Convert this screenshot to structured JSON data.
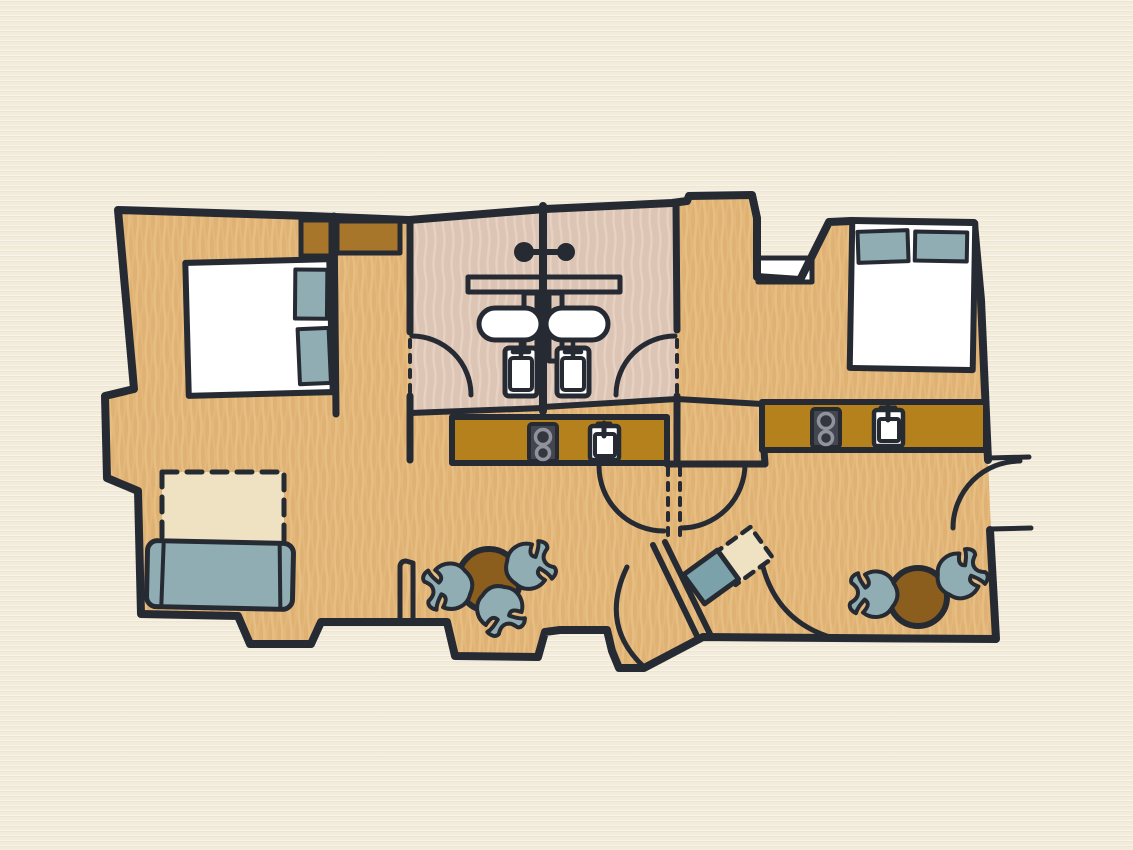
{
  "scene": {
    "type": "hand-drawn floor plan",
    "description": "Top-down illustrated floor plan of two mirrored studio apartments sharing a central bathroom block and entry vestibule",
    "units": 2,
    "visible_text": ""
  },
  "palette": {
    "page_bg": "#F3ECDB",
    "floor": "#DFB173",
    "floor_streak": "#EAC489",
    "bathroom_floor": "#DCC5B4",
    "bathroom_streak": "#E8D4C5",
    "wall": "#262A33",
    "cabinet": "#A8762B",
    "counter": "#B5811C",
    "table": "#8B5E1D",
    "upholstery": "#8FADB3",
    "desk": "#7BA2AA",
    "white": "#FFFFFF",
    "rug": "#EFE2C2",
    "stove": "#43464E",
    "burner_ring": "#8E939E",
    "burner_center": "#33363D"
  },
  "inventory": {
    "left_apartment": {
      "double_bed": 1,
      "bed_pillows": 2,
      "wardrobes": 2,
      "shower_head": 1,
      "wash_basin": 1,
      "toilet": 1,
      "kitchenette_counter": 1,
      "stove_burners": 2,
      "kitchen_sink": 1,
      "dining_table": 1,
      "dining_chairs": 3,
      "sofa": 1,
      "fold_out_rug_area": 1,
      "door_swings": 3
    },
    "right_apartment": {
      "double_bed": 1,
      "bed_pillows": 2,
      "shower_head": 1,
      "wash_basin": 1,
      "toilet": 1,
      "kitchenette_counter": 1,
      "stove_burners": 2,
      "kitchen_sink": 1,
      "dining_table": 1,
      "dining_chairs": 2,
      "desk": 1,
      "desk_dashed_area": 1,
      "entry_landing": 1,
      "door_swings": 4
    },
    "shared": {
      "central_bathroom_wall": 1,
      "bathroom_shelf": 1,
      "shower_partitions": 2,
      "entry_vestibule_threshold": 1,
      "corridor_wall": 1
    }
  }
}
